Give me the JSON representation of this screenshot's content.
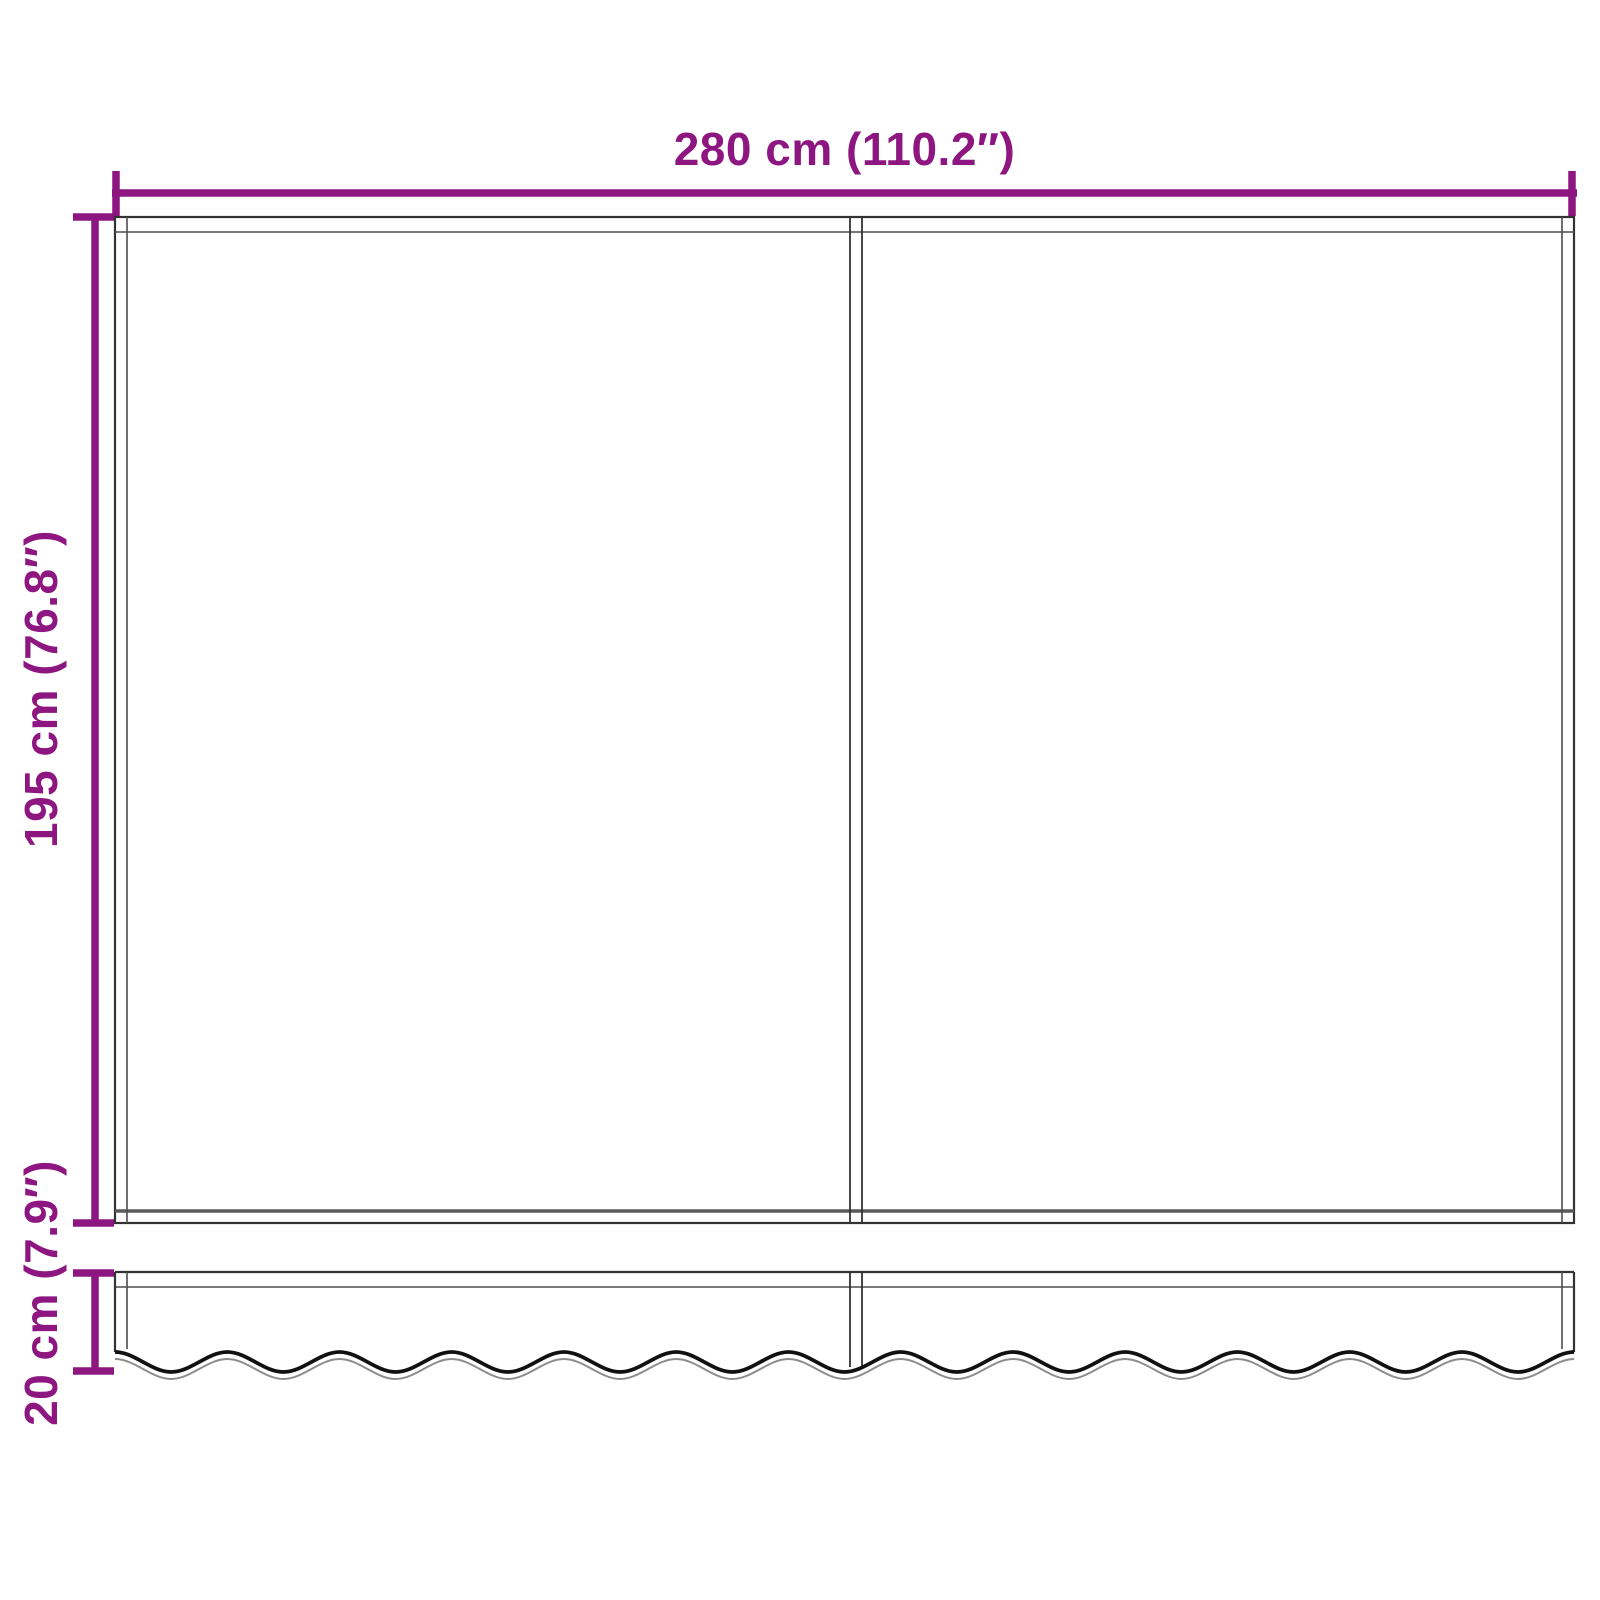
{
  "diagram": {
    "labels": {
      "width": "280 cm (110.2″)",
      "height": "195 cm (76.8″)",
      "valance_height": "20 cm (7.9″)"
    },
    "colors": {
      "accent": "#8E1680",
      "outline": "#333333",
      "hem": "#4d4d4d"
    },
    "icons": {
      "dimension_arrow": "tick-ended-dimension-line"
    }
  }
}
